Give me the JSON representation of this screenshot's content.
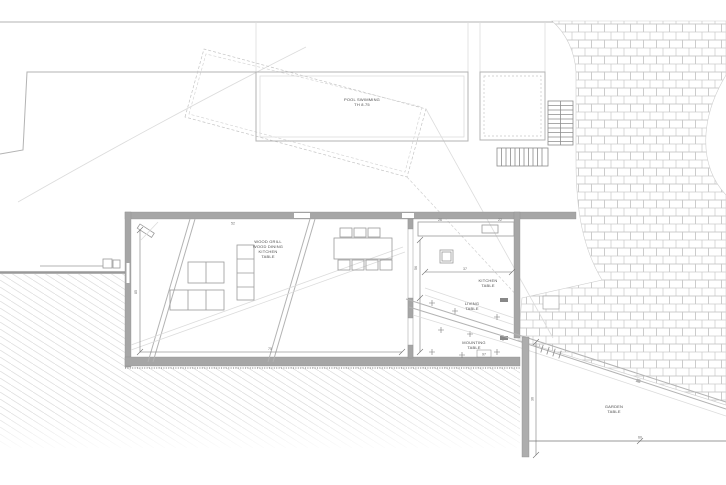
{
  "labels": {
    "pool": [
      "POOL SWIMMING",
      "TH 8.75"
    ],
    "main_room": [
      "WOOD GRILL",
      "WOOD DINING",
      "KITCHEN",
      "TABLE"
    ],
    "kitchen": [
      "KITCHEN",
      "TABLE"
    ],
    "living": [
      "LIVING",
      "TABLE"
    ],
    "mounting": [
      "MOUNTING",
      "TABLE"
    ],
    "garden_terrace": [
      "GARDEN",
      "TABLE"
    ]
  },
  "dimensions": {
    "living_room_height": "85",
    "living_room_width": "75",
    "kitchen_height": "56",
    "kitchen_width": "37",
    "top_wall_a": "52",
    "counter_a": "26",
    "counter_b": "22",
    "threshold": "97",
    "walkway": "28",
    "terrace_bottom": "60",
    "terrace_side": "36"
  },
  "colors": {
    "paper": "#ffffff",
    "wall-gray": "#a6a6a6",
    "wall-dark": "#8c8c8c",
    "line-gray": "#b3b3b3",
    "faint-gray": "#dcdcdc",
    "brick-gray": "#c8c8c8",
    "hatch-gray": "#e0e0e0",
    "dim-gray": "#6e6e6e",
    "text-gray": "#4a4a4a"
  }
}
